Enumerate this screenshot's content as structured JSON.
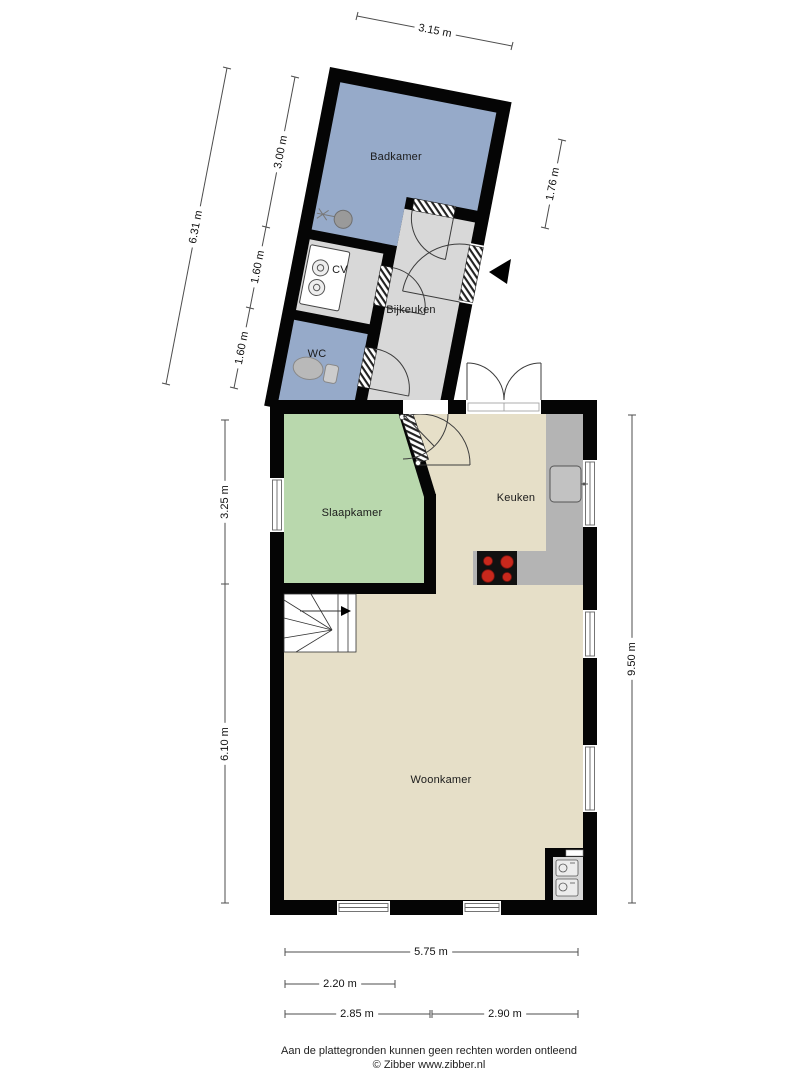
{
  "rooms": {
    "badkamer": "Badkamer",
    "cv": "CV",
    "wc": "WC",
    "bijkeuken": "Bijkeuken",
    "slaapkamer": "Slaapkamer",
    "keuken": "Keuken",
    "woonkamer": "Woonkamer"
  },
  "dimensions": {
    "d315": "3.15 m",
    "d300": "3.00 m",
    "d631": "6.31 m",
    "d160a": "1.60 m",
    "d160b": "1.60 m",
    "d176": "1.76 m",
    "d325": "3.25 m",
    "d610": "6.10 m",
    "d950": "9.50 m",
    "d575": "5.75 m",
    "d220": "2.20 m",
    "d285": "2.85 m",
    "d290": "2.90 m"
  },
  "footer": {
    "disclaimer": "Aan de plattegronden kunnen geen rechten worden ontleend",
    "copyright": "© Zibber www.zibber.nl"
  },
  "colors": {
    "wall": "#050505",
    "wet_room_blue": "#96aac9",
    "bedroom_green": "#b9d8ad",
    "living_tan": "#e6dfc8",
    "utility_gray": "#d8d8d8",
    "counter_gray": "#b4b4b4",
    "burner_red": "#c8281c",
    "swing_line": "#3c3c3c"
  },
  "icons": {
    "entrance-arrow-icon": "◀ solid triangle pointing at entry door",
    "toilet-icon": "ellipse bowl with tank",
    "boiler-icon": "rounded rect with two dials",
    "bath-sink-icon": "circle basin with faucet",
    "stove-icon": "black hob with four red burners",
    "kitchen-sink-icon": "rounded square basin on counter",
    "stairs-icon": "winder staircase with direction arrow",
    "washer-icon": "small appliance square",
    "dryer-icon": "small appliance square"
  }
}
